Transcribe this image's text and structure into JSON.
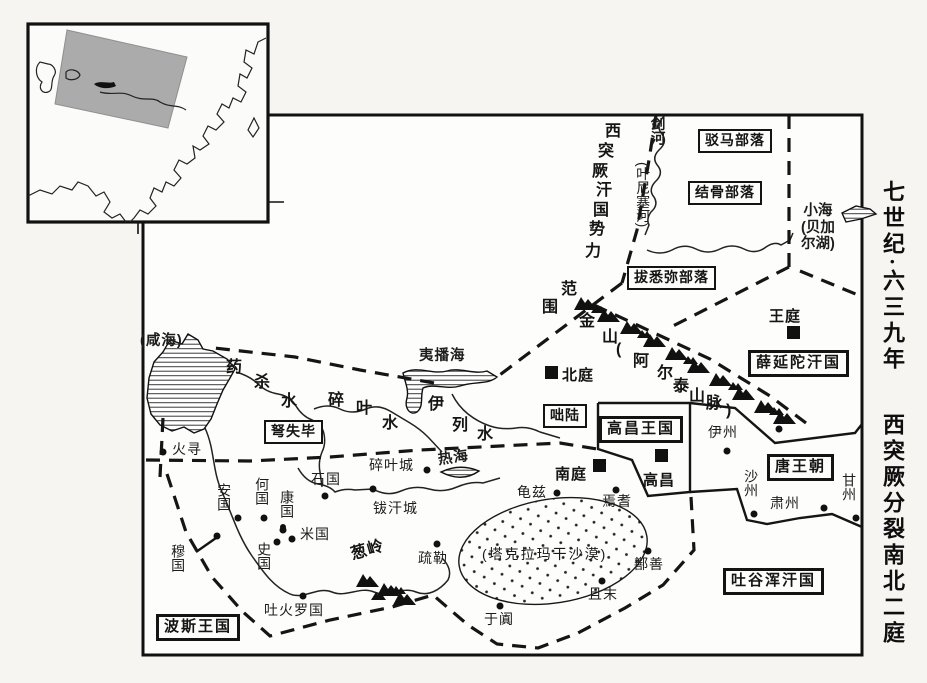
{
  "side_title": {
    "era": "七世纪·六三九年",
    "event": "西突厥分裂南北二庭"
  },
  "sphere_of_influence": "西突厥汗国势力范围",
  "region_boxes": [
    {
      "id": "boma",
      "label": "驳马部落"
    },
    {
      "id": "jiegu",
      "label": "结骨部落"
    },
    {
      "id": "baximi",
      "label": "拔悉弥部落"
    },
    {
      "id": "xueyantuo",
      "label": "薛延陀汗国"
    },
    {
      "id": "gaochang_kingdom",
      "label": "高昌王国"
    },
    {
      "id": "tang",
      "label": "唐王朝"
    },
    {
      "id": "tuyuhun",
      "label": "吐谷浑汗国"
    },
    {
      "id": "bosi",
      "label": "波斯王国"
    },
    {
      "id": "nushibi",
      "label": "弩失毕"
    },
    {
      "id": "duolu",
      "label": "咄陆"
    }
  ],
  "courts": [
    {
      "id": "wangting",
      "label": "王庭"
    },
    {
      "id": "beiting",
      "label": "北庭"
    },
    {
      "id": "nanting",
      "label": "南庭"
    },
    {
      "id": "gaochang",
      "label": "高昌"
    }
  ],
  "cities": [
    {
      "id": "huoxun",
      "label": "火寻"
    },
    {
      "id": "shiguo",
      "label": "石国"
    },
    {
      "id": "suiyecheng",
      "label": "碎叶城"
    },
    {
      "id": "bohancheng",
      "label": "钹汗城"
    },
    {
      "id": "anguo",
      "label": "安国"
    },
    {
      "id": "heguo",
      "label": "何国"
    },
    {
      "id": "kangguo",
      "label": "康国"
    },
    {
      "id": "miguo",
      "label": "米国"
    },
    {
      "id": "shi_guo",
      "label": "史国"
    },
    {
      "id": "muguo",
      "label": "穆国"
    },
    {
      "id": "tuhuoluoguo",
      "label": "吐火罗国"
    },
    {
      "id": "shule",
      "label": "疏勒"
    },
    {
      "id": "yutian",
      "label": "于阗"
    },
    {
      "id": "qiuci",
      "label": "龟兹"
    },
    {
      "id": "yanqi",
      "label": "焉耆"
    },
    {
      "id": "shanshan",
      "label": "鄯善"
    },
    {
      "id": "qiemo",
      "label": "且末"
    },
    {
      "id": "yizhou",
      "label": "伊州"
    },
    {
      "id": "shazhou",
      "label": "沙州"
    },
    {
      "id": "suzhou",
      "label": "肃州"
    },
    {
      "id": "ganzhou",
      "label": "甘州"
    }
  ],
  "waters": [
    {
      "id": "xianhai",
      "label": "(咸海)"
    },
    {
      "id": "yibohai",
      "label": "夷播海"
    },
    {
      "id": "rehai",
      "label": "热海"
    },
    {
      "id": "xiaohai",
      "label": "小海\n(贝加\n尔湖)"
    },
    {
      "id": "jianhe",
      "label": "剑河"
    },
    {
      "id": "yenisai",
      "label": "(叶尼塞河)"
    },
    {
      "id": "yaoshashui",
      "label": "药杀水"
    },
    {
      "id": "suiyeshui",
      "label": "碎叶水"
    },
    {
      "id": "yilieshui",
      "label": "伊列水"
    }
  ],
  "mountains": [
    {
      "id": "jinshan",
      "label": "金山(阿尔泰山脉)"
    },
    {
      "id": "congling",
      "label": "葱岭"
    }
  ],
  "desert": {
    "label": "(塔克拉玛干沙漠)"
  },
  "ink_color": "#141414"
}
